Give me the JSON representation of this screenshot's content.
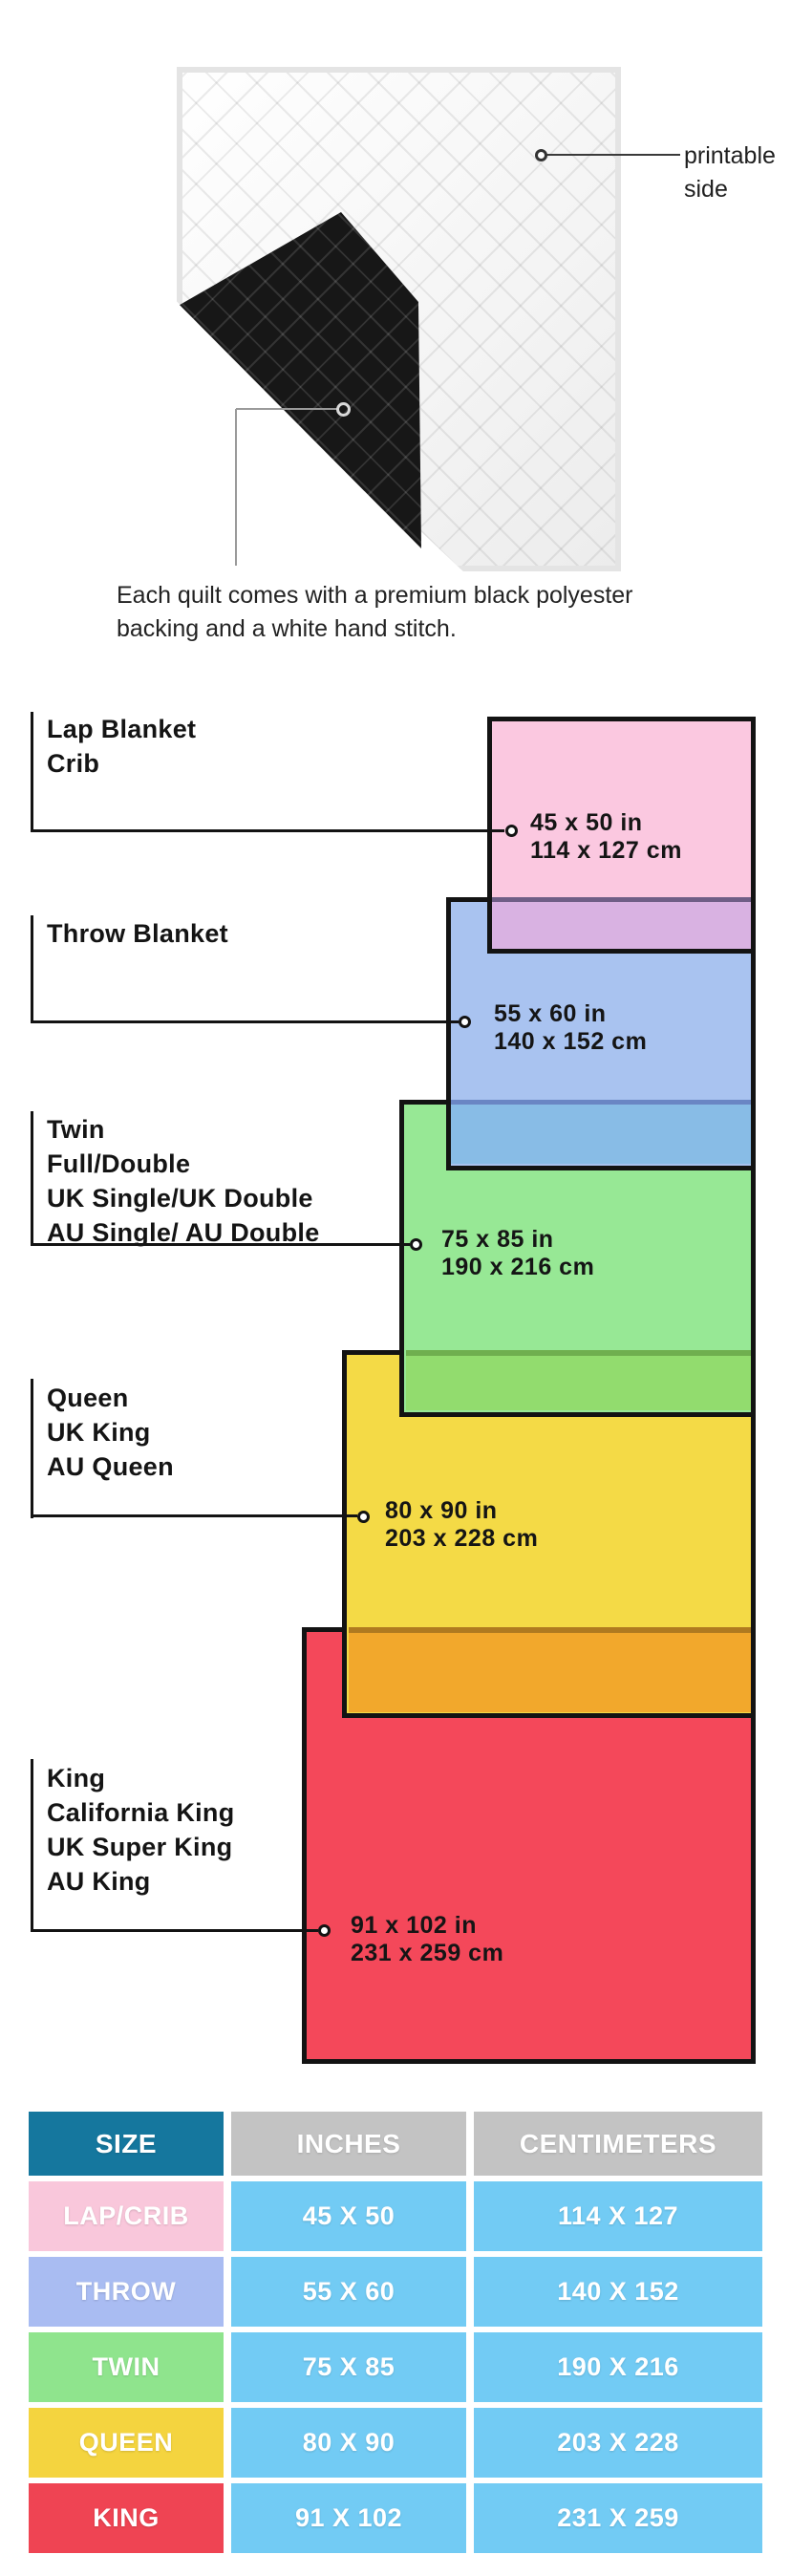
{
  "hero": {
    "printable_label": [
      "printable",
      "side"
    ],
    "caption": [
      "Each quilt comes with a premium black polyester",
      "backing and a white hand stitch."
    ]
  },
  "diagram": {
    "groups": [
      {
        "id": "lap-crib",
        "names": [
          "Lap Blanket",
          "Crib"
        ],
        "inches": "45 x 50 in",
        "cm": "114 x 127 cm",
        "color": "#FBC8E0"
      },
      {
        "id": "throw",
        "names": [
          "Throw Blanket"
        ],
        "inches": "55 x 60 in",
        "cm": "140 x 152 cm",
        "color": "#A9C3F0"
      },
      {
        "id": "twin",
        "names": [
          "Twin",
          "Full/Double",
          "UK Single/UK Double",
          "AU Single/ AU Double"
        ],
        "inches": "75 x 85 in",
        "cm": "190 x 216 cm",
        "color": "#97E895"
      },
      {
        "id": "queen",
        "names": [
          "Queen",
          "UK King",
          "AU Queen"
        ],
        "inches": "80 x 90 in",
        "cm": "203 x 228 cm",
        "color": "#F4DA46"
      },
      {
        "id": "king",
        "names": [
          "King",
          "California King",
          "UK Super King",
          "AU King"
        ],
        "inches": "91 x 102 in",
        "cm": "231 x 259 cm",
        "color": "#F4485A"
      }
    ],
    "overlap_colors": {
      "pink_over_blue": "#D9B2E2",
      "blue_border_under_pink": "#6F5E86",
      "blue_over_green": "#88BCE6",
      "green_border_under_blue": "#6A86C4",
      "green_over_yellow": "#92DC6E",
      "yellow_border_under_green": "#6FAF4F",
      "yellow_over_red": "#F2A82C",
      "red_border_under_yellow": "#AF7A20",
      "outline": "#131313"
    }
  },
  "table": {
    "header": {
      "size": "SIZE",
      "inches": "INCHES",
      "cm": "CENTIMETERS"
    },
    "header_colors": {
      "size_bg": "#15779E",
      "other_bg": "#C3C3C3"
    },
    "cell_bg": "#72CBF4",
    "rows": [
      {
        "size": "LAP/CRIB",
        "inches": "45 X 50",
        "cm": "114 X 127",
        "color": "#F9C7DB"
      },
      {
        "size": "THROW",
        "inches": "55 X 60",
        "cm": "140 X 152",
        "color": "#A9BCF2"
      },
      {
        "size": "TWIN",
        "inches": "75 X 85",
        "cm": "190 X 216",
        "color": "#8FE48D"
      },
      {
        "size": "QUEEN",
        "inches": "80 X 90",
        "cm": "203 X 228",
        "color": "#F4D43F"
      },
      {
        "size": "KING",
        "inches": "91 X 102",
        "cm": "231 X 259",
        "color": "#EF4453"
      }
    ]
  }
}
